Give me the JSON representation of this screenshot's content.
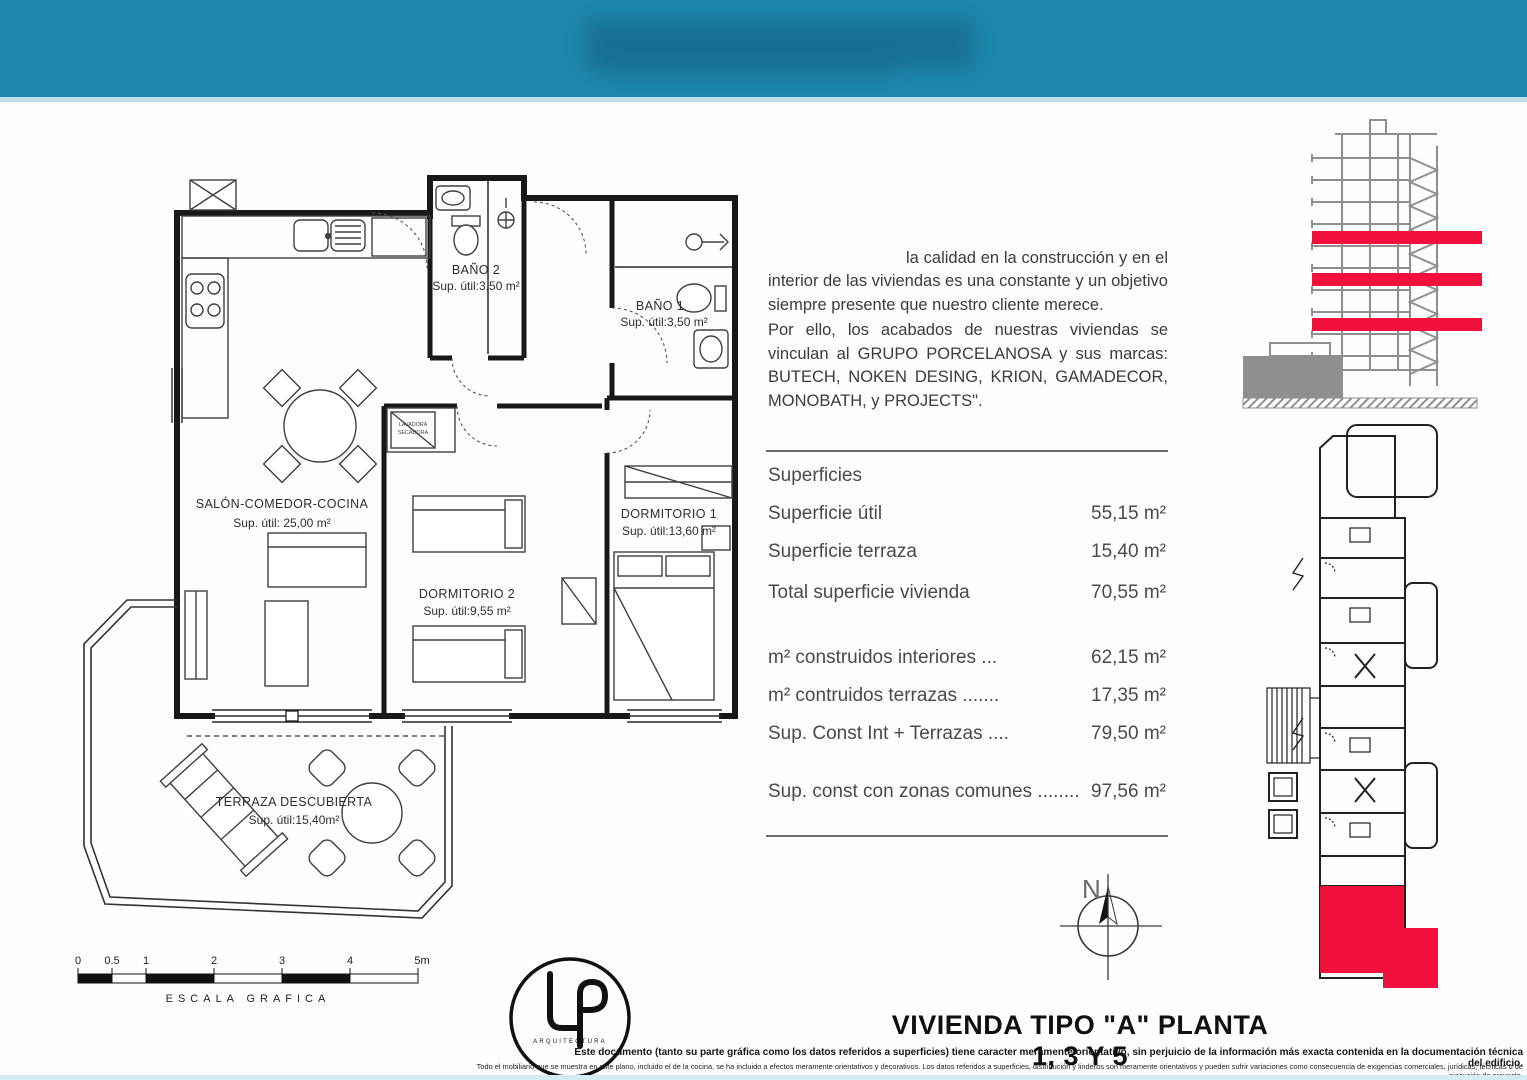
{
  "header": {
    "color": "#1e86ac"
  },
  "accent": {
    "red": "#f2103d",
    "teal": "#1e86ac",
    "gray": "#8f8f8f"
  },
  "quality_text": {
    "p1": "la calidad en la construcción y en el interior de las viviendas es una constante y un objetivo siempre presente que nuestro cliente merece.",
    "p2": "Por ello, los acabados de nuestras viviendas se vinculan al GRUPO PORCELANOSA y sus marcas: BUTECH, NOKEN DESING, KRION, GAMADECOR, MONOBATH, y PROJECTS\"."
  },
  "superficies": {
    "heading": "Superficies",
    "rows": [
      {
        "label": "Superficie útil",
        "value": "55,15 m²"
      },
      {
        "label": "Superficie terraza",
        "value": "15,40 m²"
      },
      {
        "label": "Total superficie vivienda",
        "value": "70,55 m²"
      },
      {
        "label": "m² construidos interiores ...",
        "value": "62,15 m²"
      },
      {
        "label": "m² contruidos terrazas .......",
        "value": "17,35 m²"
      },
      {
        "label": "Sup. Const Int + Terrazas ....",
        "value": "79,50 m²"
      },
      {
        "label": "Sup. const con zonas comunes ........",
        "value": "97,56 m²"
      }
    ]
  },
  "plan": {
    "rooms": [
      {
        "name": "SALÓN-COMEDOR-COCINA",
        "area": "Sup. útil: 25,00 m²"
      },
      {
        "name": "DORMITORIO 2",
        "area": "Sup. útil:9,55 m²"
      },
      {
        "name": "DORMITORIO 1",
        "area": "Sup. útil:13,60 m²"
      },
      {
        "name": "BAÑO 2",
        "area": "Sup. útil:3,50 m²"
      },
      {
        "name": "BAÑO 1",
        "area": "Sup. útil:3,50 m²"
      },
      {
        "name": "TERRAZA DESCUBIERTA",
        "area": "Sup. útil:15,40m²"
      }
    ],
    "washer_line1": "LAVADORA",
    "washer_line2": "SECADORA"
  },
  "scale_bar": {
    "ticks": [
      "0",
      "0.5",
      "1",
      "2",
      "3",
      "4",
      "5m"
    ],
    "label": "ESCALA  GRAFICA"
  },
  "compass": {
    "letter": "N"
  },
  "logo": {
    "caption": "ARQUITECTURA"
  },
  "footer": {
    "title": "VIVIENDA TIPO \"A\" PLANTA 1, 3 Y 5",
    "disclaimer1": "Este documento (tanto su parte gráfica como los datos referidos a superficies) tiene caracter meramente orientativo, sin perjuicio de la información más exacta contenida en la documentación técnica del edificio.",
    "disclaimer2": "Todo el mobiliario que se muestra en este plano, incluido el de la cocina, se ha incluido a efectos meramente orientativos y decorativos. Los datos referidos a superficies, distribución y linderos son meramente orientativos y pueden sufrir variaciones como consecuencia de exigencias comerciales, jurídicas, técnicas o de ejecución de proyecto."
  }
}
